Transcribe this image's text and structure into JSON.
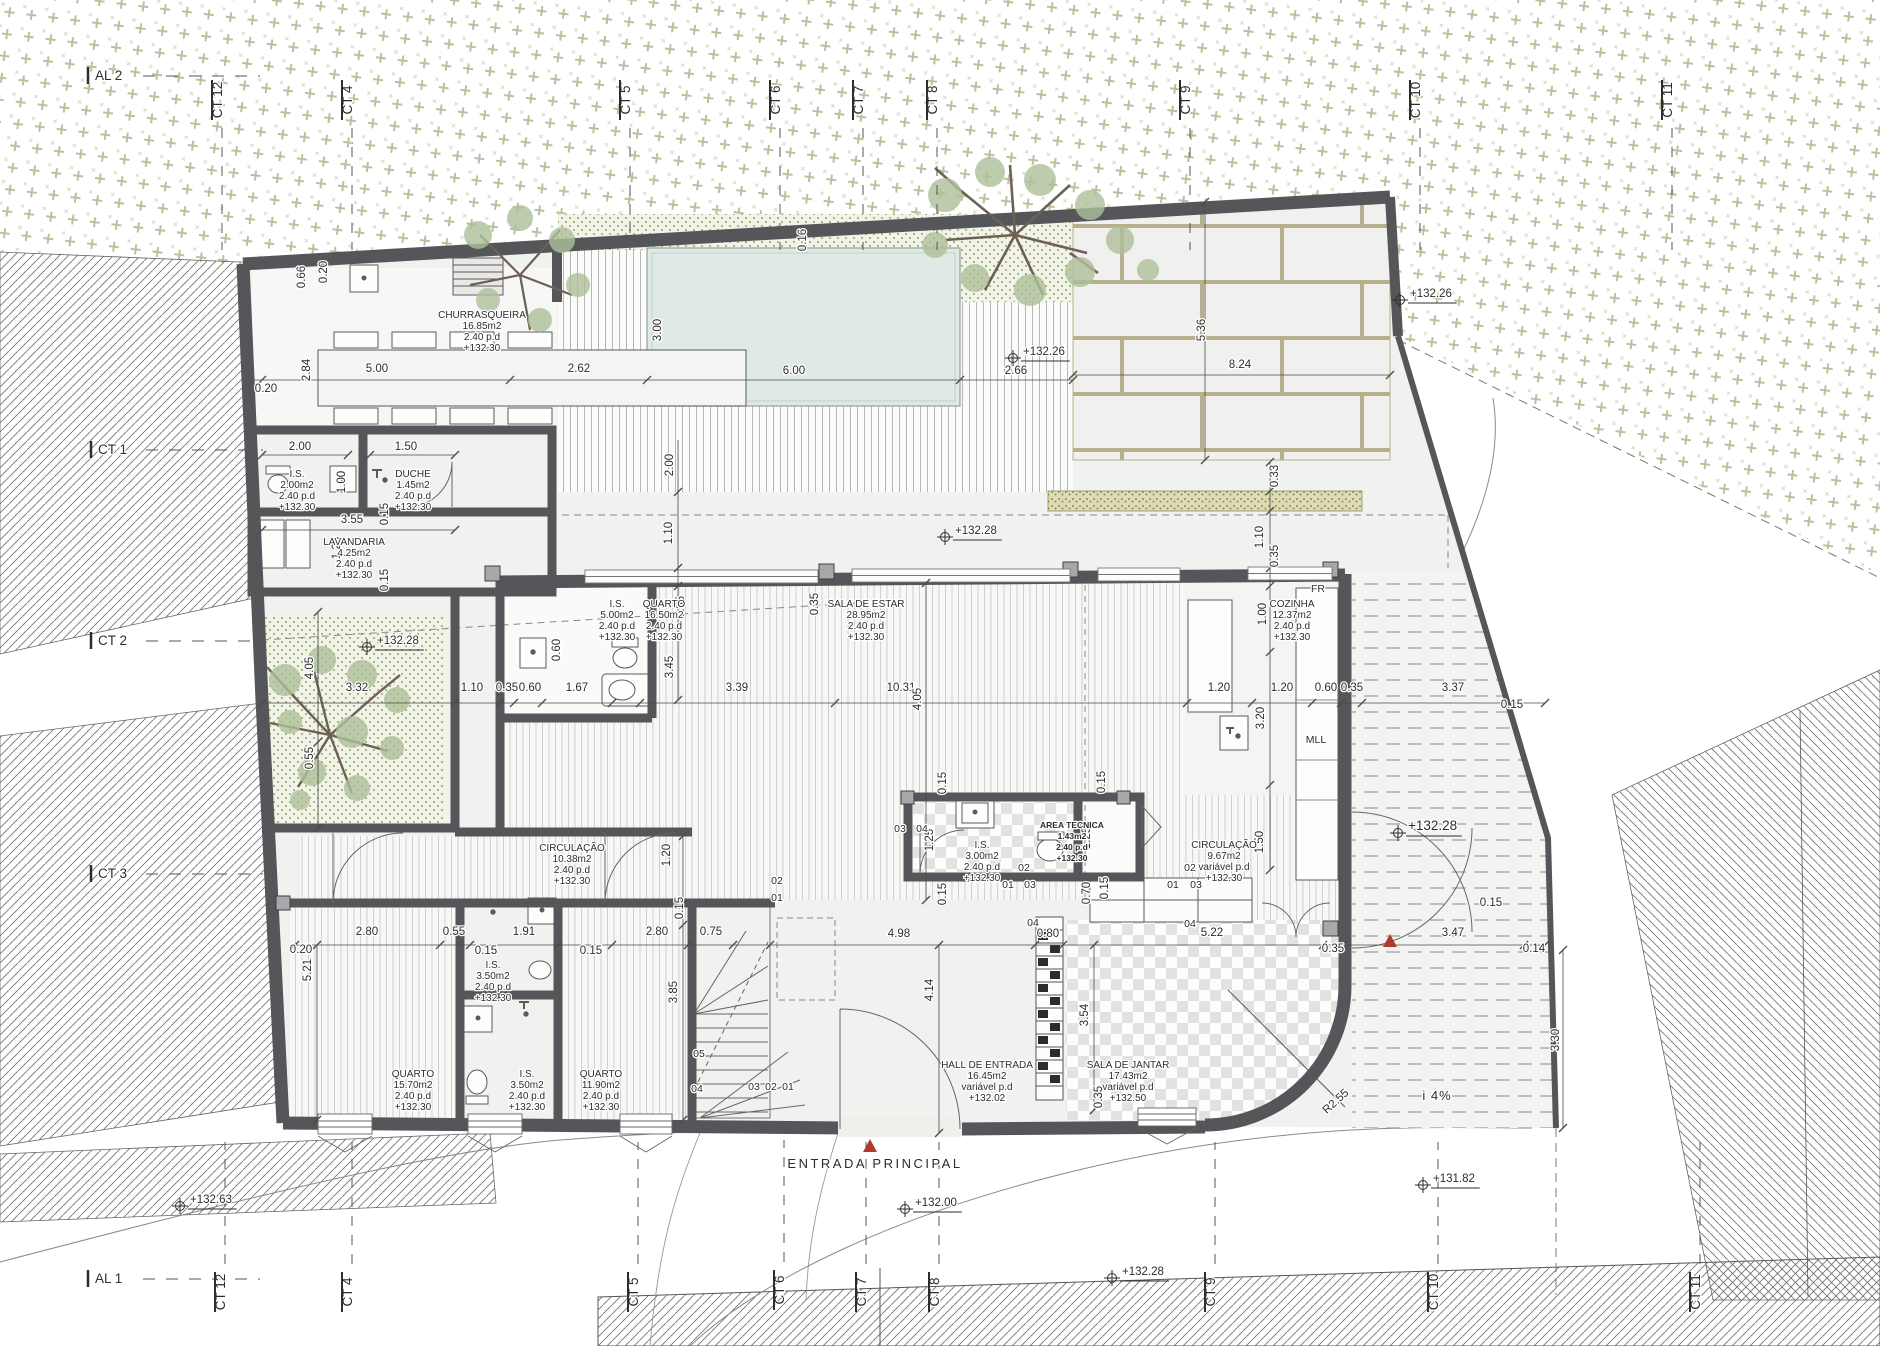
{
  "colors": {
    "wall": "#55565a",
    "text": "#2d2d2d",
    "pool": "#e0eae4",
    "pool_edge": "#8fa49b",
    "veg": "#a3ac7d",
    "hatch": "#737373",
    "brick_joint": "#b7b08c",
    "khaki": "#dedcb4",
    "khaki_dot": "#8c8e58",
    "courtyard_dot": "#a3b07f",
    "foliage": "#aec09a",
    "branch": "#6e6054",
    "entry_red": "#b03a2e",
    "site_bg": "#f1f1ef"
  },
  "rooms": [
    {
      "name": "CHURRASQUEIRA",
      "area": "16.85m2",
      "pd": "2.40  p.d",
      "level": "+132.30",
      "x": 482,
      "y": 318
    },
    {
      "name": "I.S.",
      "area": "2.00m2",
      "pd": "2.40  p.d",
      "level": "+132.30",
      "x": 297,
      "y": 477
    },
    {
      "name": "DUCHE",
      "area": "1.45m2",
      "pd": "2.40  p.d",
      "level": "+132.30",
      "x": 413,
      "y": 477
    },
    {
      "name": "LAVANDARIA",
      "area": "4.25m2",
      "pd": "2.40  p.d",
      "level": "+132.30",
      "x": 354,
      "y": 545
    },
    {
      "name": "I.S.",
      "area": "5.00m2",
      "pd": "2.40  p.d",
      "level": "+132.30",
      "x": 617,
      "y": 607
    },
    {
      "name": "QUARTO",
      "area": "16.50m2",
      "pd": "2.40  p.d",
      "level": "+132.30",
      "x": 664,
      "y": 607
    },
    {
      "name": "SALA DE ESTAR",
      "area": "28.95m2",
      "pd": "2.40  p.d",
      "level": "+132.30",
      "x": 866,
      "y": 607
    },
    {
      "name": "COZINHA",
      "area": "12.37m2",
      "pd": "2.40  p.d",
      "level": "+132.30",
      "x": 1292,
      "y": 607
    },
    {
      "name": "I.S.",
      "area": "3.00m2",
      "pd": "2.40  p.d",
      "level": "+132.30",
      "x": 982,
      "y": 848
    },
    {
      "name": "AREA TECNICA",
      "area": "1.43m2",
      "pd": "2.40  p.d",
      "level": "+132.30",
      "x": 1072,
      "y": 828,
      "small": 1
    },
    {
      "name": "CIRCULAÇÃO",
      "area": "9.67m2",
      "pd": "variável  p.d",
      "level": "+132.30",
      "x": 1224,
      "y": 848
    },
    {
      "name": "CIRCULAÇÃO",
      "area": "10.38m2",
      "pd": "2.40  p.d",
      "level": "+132.30",
      "x": 572,
      "y": 851
    },
    {
      "name": "QUARTO",
      "area": "15.70m2",
      "pd": "2.40  p.d",
      "level": "+132.30",
      "x": 413,
      "y": 1077
    },
    {
      "name": "I.S.",
      "area": "3.50m2",
      "pd": "2.40  p.d",
      "level": "+132.30",
      "x": 493,
      "y": 968
    },
    {
      "name": "I.S.",
      "area": "3.50m2",
      "pd": "2.40  p.d",
      "level": "+132.30",
      "x": 527,
      "y": 1077
    },
    {
      "name": "QUARTO",
      "area": "11.90m2",
      "pd": "2.40  p.d",
      "level": "+132.30",
      "x": 601,
      "y": 1077
    },
    {
      "name": "HALL DE ENTRADA",
      "area": "16.45m2",
      "pd": "variável  p.d",
      "level": "+132.02",
      "x": 987,
      "y": 1068
    },
    {
      "name": "SALA DE JANTAR",
      "area": "17.43m2",
      "pd": "variável  p.d",
      "level": "+132.50",
      "x": 1128,
      "y": 1068
    }
  ],
  "grid_markers": [
    {
      "t": "AL 2",
      "x": 95,
      "y": 80,
      "o": "h",
      "side": "top"
    },
    {
      "t": "CT 12",
      "x": 222,
      "y": 100,
      "o": "v",
      "side": "top"
    },
    {
      "t": "CT 4",
      "x": 352,
      "y": 100,
      "o": "v",
      "side": "top"
    },
    {
      "t": "CT 5",
      "x": 630,
      "y": 100,
      "o": "v",
      "side": "top"
    },
    {
      "t": "CT 6",
      "x": 780,
      "y": 100,
      "o": "v",
      "side": "top"
    },
    {
      "t": "CT 7",
      "x": 863,
      "y": 100,
      "o": "v",
      "side": "top"
    },
    {
      "t": "CT 8",
      "x": 937,
      "y": 100,
      "o": "v",
      "side": "top"
    },
    {
      "t": "CT 9",
      "x": 1190,
      "y": 100,
      "o": "v",
      "side": "top"
    },
    {
      "t": "CT 10",
      "x": 1420,
      "y": 100,
      "o": "v",
      "side": "top"
    },
    {
      "t": "CT 11",
      "x": 1672,
      "y": 100,
      "o": "v",
      "side": "top"
    },
    {
      "t": "AL 1",
      "x": 95,
      "y": 1283,
      "o": "h",
      "side": "bot"
    },
    {
      "t": "CT 12",
      "x": 225,
      "y": 1292,
      "o": "v",
      "side": "bot"
    },
    {
      "t": "CT 4",
      "x": 352,
      "y": 1292,
      "o": "v",
      "side": "bot"
    },
    {
      "t": "CT 5",
      "x": 638,
      "y": 1292,
      "o": "v",
      "side": "bot"
    },
    {
      "t": "CT 6",
      "x": 784,
      "y": 1290,
      "o": "v",
      "side": "bot"
    },
    {
      "t": "CT 7",
      "x": 866,
      "y": 1292,
      "o": "v",
      "side": "bot"
    },
    {
      "t": "CT 8",
      "x": 939,
      "y": 1292,
      "o": "v",
      "side": "bot"
    },
    {
      "t": "CT 9",
      "x": 1215,
      "y": 1292,
      "o": "v",
      "side": "bot"
    },
    {
      "t": "CT 10",
      "x": 1438,
      "y": 1292,
      "o": "v",
      "side": "bot"
    },
    {
      "t": "CT 11",
      "x": 1700,
      "y": 1292,
      "o": "v",
      "side": "bot"
    },
    {
      "t": "CT 1",
      "x": 98,
      "y": 454,
      "o": "h",
      "side": "left"
    },
    {
      "t": "CT 2",
      "x": 98,
      "y": 645,
      "o": "h",
      "side": "left"
    },
    {
      "t": "CT 3",
      "x": 98,
      "y": 878,
      "o": "h",
      "side": "left"
    }
  ],
  "levels": [
    {
      "t": "+132.26",
      "x": 1013,
      "y": 358
    },
    {
      "t": "+132.26",
      "x": 1400,
      "y": 300
    },
    {
      "t": "+132.28",
      "x": 945,
      "y": 537
    },
    {
      "t": "+132.28",
      "x": 367,
      "y": 647
    },
    {
      "t": "+132.28",
      "x": 1398,
      "y": 833,
      "big": 1
    },
    {
      "t": "+132.63",
      "x": 180,
      "y": 1206
    },
    {
      "t": "+132.00",
      "x": 905,
      "y": 1209
    },
    {
      "t": "+132.28",
      "x": 1112,
      "y": 1278
    },
    {
      "t": "+131.82",
      "x": 1423,
      "y": 1185
    }
  ],
  "dimensions": [
    {
      "t": "5.00",
      "x": 377,
      "y": 372
    },
    {
      "t": "2.62",
      "x": 579,
      "y": 372
    },
    {
      "t": "6.00",
      "x": 794,
      "y": 374
    },
    {
      "t": "2.66",
      "x": 1016,
      "y": 374
    },
    {
      "t": "8.24",
      "x": 1240,
      "y": 368
    },
    {
      "t": "5.36",
      "x": 1205,
      "y": 330,
      "r": 1
    },
    {
      "t": "0.16",
      "x": 806,
      "y": 240,
      "r": 1
    },
    {
      "t": "3.00",
      "x": 661,
      "y": 330,
      "r": 1
    },
    {
      "t": "0.66",
      "x": 305,
      "y": 277,
      "r": 1
    },
    {
      "t": "0.20",
      "x": 327,
      "y": 272,
      "r": 1
    },
    {
      "t": "2.84",
      "x": 310,
      "y": 370,
      "r": 1
    },
    {
      "t": "0.20",
      "x": 266,
      "y": 392
    },
    {
      "t": "2.00",
      "x": 300,
      "y": 450
    },
    {
      "t": "1.50",
      "x": 406,
      "y": 450
    },
    {
      "t": "1.00",
      "x": 345,
      "y": 482,
      "r": 1
    },
    {
      "t": "3.55",
      "x": 352,
      "y": 523
    },
    {
      "t": "0.15",
      "x": 388,
      "y": 514,
      "r": 1
    },
    {
      "t": "1.20",
      "x": 340,
      "y": 548,
      "r": 1
    },
    {
      "t": "0.15",
      "x": 388,
      "y": 580,
      "r": 1
    },
    {
      "t": "2.00",
      "x": 673,
      "y": 465,
      "r": 1
    },
    {
      "t": "1.10",
      "x": 672,
      "y": 533,
      "r": 1
    },
    {
      "t": "0.33",
      "x": 1278,
      "y": 476,
      "r": 1
    },
    {
      "t": "1.10",
      "x": 1263,
      "y": 537,
      "r": 1
    },
    {
      "t": "0.35",
      "x": 1278,
      "y": 556,
      "r": 1
    },
    {
      "t": "1.00",
      "x": 1266,
      "y": 614,
      "r": 1
    },
    {
      "t": "3.20",
      "x": 1264,
      "y": 718,
      "r": 1
    },
    {
      "t": "1.50",
      "x": 1263,
      "y": 842,
      "r": 1
    },
    {
      "t": "3.32",
      "x": 357,
      "y": 691
    },
    {
      "t": "4.05",
      "x": 313,
      "y": 668,
      "r": 1
    },
    {
      "t": "0.55",
      "x": 313,
      "y": 758,
      "r": 1
    },
    {
      "t": "1.10",
      "x": 472,
      "y": 691
    },
    {
      "t": "0.35",
      "x": 507,
      "y": 691
    },
    {
      "t": "0.60",
      "x": 530,
      "y": 691
    },
    {
      "t": "1.67",
      "x": 577,
      "y": 691
    },
    {
      "t": "3.39",
      "x": 737,
      "y": 691
    },
    {
      "t": "10.31",
      "x": 901,
      "y": 691
    },
    {
      "t": "4.05",
      "x": 921,
      "y": 699,
      "r": 1
    },
    {
      "t": "1.20",
      "x": 1219,
      "y": 691
    },
    {
      "t": "1.20",
      "x": 1282,
      "y": 691
    },
    {
      "t": "0.60",
      "x": 1326,
      "y": 691
    },
    {
      "t": "0.35",
      "x": 1352,
      "y": 691
    },
    {
      "t": "3.37",
      "x": 1453,
      "y": 691
    },
    {
      "t": "0.15",
      "x": 1512,
      "y": 708
    },
    {
      "t": "0.15",
      "x": 1491,
      "y": 906
    },
    {
      "t": "3.45",
      "x": 673,
      "y": 667,
      "r": 1
    },
    {
      "t": "0.35",
      "x": 684,
      "y": 607,
      "r": 1
    },
    {
      "t": "0.35",
      "x": 818,
      "y": 604,
      "r": 1
    },
    {
      "t": "0.60",
      "x": 560,
      "y": 650,
      "r": 1
    },
    {
      "t": "0.15",
      "x": 946,
      "y": 783,
      "r": 1
    },
    {
      "t": "0.15",
      "x": 1105,
      "y": 782,
      "r": 1
    },
    {
      "t": "1.25",
      "x": 933,
      "y": 840,
      "r": 1
    },
    {
      "t": "1.25",
      "x": 1090,
      "y": 838,
      "r": 1
    },
    {
      "t": "0.15",
      "x": 946,
      "y": 894,
      "r": 1
    },
    {
      "t": "0.15",
      "x": 1108,
      "y": 888,
      "r": 1
    },
    {
      "t": "0.70",
      "x": 1090,
      "y": 893,
      "r": 1
    },
    {
      "t": "0.20",
      "x": 301,
      "y": 953
    },
    {
      "t": "5.21",
      "x": 311,
      "y": 970,
      "r": 1
    },
    {
      "t": "2.80",
      "x": 367,
      "y": 935
    },
    {
      "t": "0.55",
      "x": 454,
      "y": 935
    },
    {
      "t": "1.91",
      "x": 524,
      "y": 935
    },
    {
      "t": "0.15",
      "x": 486,
      "y": 954
    },
    {
      "t": "0.15",
      "x": 591,
      "y": 954
    },
    {
      "t": "2.80",
      "x": 657,
      "y": 935
    },
    {
      "t": "0.75",
      "x": 711,
      "y": 935
    },
    {
      "t": "4.98",
      "x": 899,
      "y": 937
    },
    {
      "t": "0.80",
      "x": 1048,
      "y": 937
    },
    {
      "t": "5.22",
      "x": 1212,
      "y": 936
    },
    {
      "t": "0.35",
      "x": 1333,
      "y": 952
    },
    {
      "t": "3.47",
      "x": 1453,
      "y": 936
    },
    {
      "t": "0.14",
      "x": 1534,
      "y": 952
    },
    {
      "t": "3.85",
      "x": 677,
      "y": 992,
      "r": 1
    },
    {
      "t": "1.20",
      "x": 670,
      "y": 855,
      "r": 1
    },
    {
      "t": "0.15",
      "x": 683,
      "y": 908,
      "r": 1
    },
    {
      "t": "4.14",
      "x": 933,
      "y": 990,
      "r": 1
    },
    {
      "t": "3.54",
      "x": 1088,
      "y": 1015,
      "r": 1
    },
    {
      "t": "0.35",
      "x": 1102,
      "y": 1097,
      "r": 1
    },
    {
      "t": "3.30",
      "x": 1559,
      "y": 1040,
      "r": 1
    }
  ],
  "tags": [
    {
      "t": "02",
      "x": 1024,
      "y": 871
    },
    {
      "t": "01",
      "x": 1008,
      "y": 888
    },
    {
      "t": "03",
      "x": 1030,
      "y": 888
    },
    {
      "t": "04",
      "x": 1033,
      "y": 926
    },
    {
      "t": "02",
      "x": 1190,
      "y": 871
    },
    {
      "t": "01",
      "x": 1173,
      "y": 888
    },
    {
      "t": "03",
      "x": 1196,
      "y": 888
    },
    {
      "t": "04",
      "x": 1190,
      "y": 927
    },
    {
      "t": "02",
      "x": 777,
      "y": 884
    },
    {
      "t": "01",
      "x": 777,
      "y": 901
    },
    {
      "t": "03",
      "x": 900,
      "y": 832
    },
    {
      "t": "04",
      "x": 922,
      "y": 832
    },
    {
      "t": "05",
      "x": 699,
      "y": 1057
    },
    {
      "t": "04",
      "x": 697,
      "y": 1092
    },
    {
      "t": "03",
      "x": 754,
      "y": 1090
    },
    {
      "t": "02",
      "x": 771,
      "y": 1090
    },
    {
      "t": "01",
      "x": 788,
      "y": 1090
    },
    {
      "t": "FR",
      "x": 1318,
      "y": 592
    },
    {
      "t": "MLL",
      "x": 1316,
      "y": 743
    }
  ],
  "annotations": [
    {
      "t": "ENTRADA  PRINCIPAL",
      "x": 875,
      "y": 1168,
      "cls": "ann"
    },
    {
      "t": "i  4%",
      "x": 1437,
      "y": 1100,
      "cls": "ann2"
    },
    {
      "t": "R2.55",
      "x": 1338,
      "y": 1104,
      "rot": -42,
      "cls": "dim"
    }
  ],
  "entry_markers": [
    {
      "x": 870,
      "y": 1146
    },
    {
      "x": 1390,
      "y": 941
    }
  ],
  "dimension_lines": {
    "h": [
      {
        "y": 380,
        "x1": 252,
        "x2": 1073,
        "ticks": [
          262,
          510,
          647,
          960,
          1073
        ]
      },
      {
        "y": 375,
        "x1": 1073,
        "x2": 1390,
        "ticks": [
          1073,
          1390
        ]
      },
      {
        "y": 703,
        "x1": 262,
        "x2": 1545,
        "ticks": [
          262,
          455,
          500,
          514,
          542,
          612,
          640,
          835,
          1187,
          1252,
          1312,
          1341,
          1362,
          1545
        ]
      },
      {
        "y": 945,
        "x1": 295,
        "x2": 1545,
        "ticks": [
          295,
          440,
          470,
          558,
          612,
          688,
          733,
          770,
          1035,
          1063,
          1323,
          1343,
          1524,
          1545
        ]
      },
      {
        "y": 455,
        "x1": 262,
        "x2": 348,
        "ticks": [
          262,
          348
        ]
      },
      {
        "y": 455,
        "x1": 370,
        "x2": 455,
        "ticks": [
          370,
          455
        ]
      },
      {
        "y": 530,
        "x1": 262,
        "x2": 455,
        "ticks": [
          262,
          455
        ]
      }
    ],
    "v": [
      {
        "x": 678,
        "y1": 440,
        "y2": 700,
        "ticks": [
          492,
          568,
          586,
          700
        ]
      },
      {
        "x": 1270,
        "y1": 462,
        "y2": 870,
        "ticks": [
          462,
          491,
          511,
          568,
          586,
          652,
          785,
          870
        ]
      },
      {
        "x": 318,
        "y1": 612,
        "y2": 828,
        "ticks": [
          612,
          742,
          828
        ]
      },
      {
        "x": 317,
        "y1": 945,
        "y2": 1120,
        "ticks": [
          945,
          1120
        ]
      },
      {
        "x": 683,
        "y1": 836,
        "y2": 1120,
        "ticks": [
          836,
          904,
          925,
          1120
        ]
      },
      {
        "x": 939,
        "y1": 945,
        "y2": 1133,
        "ticks": [
          945,
          1133
        ]
      },
      {
        "x": 1094,
        "y1": 945,
        "y2": 1110,
        "ticks": [
          945,
          1110
        ]
      },
      {
        "x": 1563,
        "y1": 950,
        "y2": 1128,
        "ticks": [
          950,
          1128
        ]
      },
      {
        "x": 1205,
        "y1": 202,
        "y2": 460,
        "ticks": [
          202,
          460
        ]
      },
      {
        "x": 926,
        "y1": 583,
        "y2": 900,
        "ticks": [
          583,
          900
        ]
      }
    ]
  }
}
